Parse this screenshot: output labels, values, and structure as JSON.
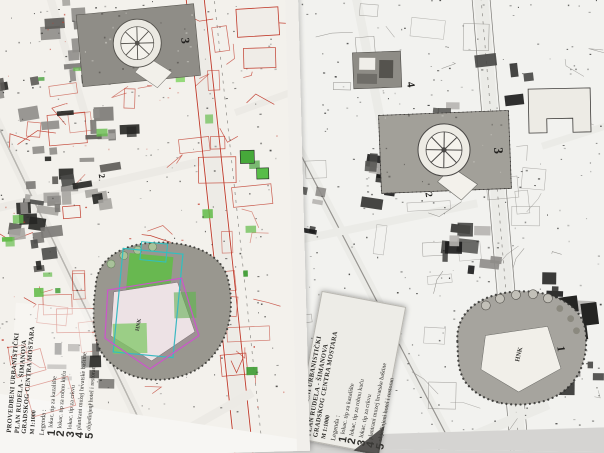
{
  "page": {
    "background": "#d5d4d2"
  },
  "colors": {
    "paper_left": "#f3f1ec",
    "paper_right": "#f2f2ef",
    "page_bg": "#d5d4d2",
    "parcel_red": "#c03a2b",
    "vegetation_green": "#63bb49",
    "vegetation_dark": "#3f9c34",
    "overlay_cyan": "#2fc0c0",
    "overlay_magenta": "#cc55cb",
    "plaza_gray": "#8f8d87",
    "park_gray": "#99978f"
  },
  "map_labels": {
    "plaza": "3",
    "museum": "4",
    "store": "2",
    "park": "1",
    "theatre": "HNK"
  },
  "legend": {
    "title_line1": "PROVEDBENI URBANISTIČKI",
    "title_line2": "PLAN RUDELA - ŠIMANOVA",
    "title_line3": "GRADSKOG CENTRA MOSTARA",
    "scale": "M 1:1000",
    "heading": "Legenda :",
    "items": [
      {
        "num": "1",
        "label": "lokac. tip za kazalište"
      },
      {
        "num": "2",
        "label": "lokac. tip za robnu kuću"
      },
      {
        "num": "3",
        "label": "lokac. tip za crkvu"
      },
      {
        "num": "4",
        "label": "planirani muzej hrvatske baštine"
      },
      {
        "num": "5",
        "label": "objedinjeni hotel i restoran"
      }
    ]
  }
}
